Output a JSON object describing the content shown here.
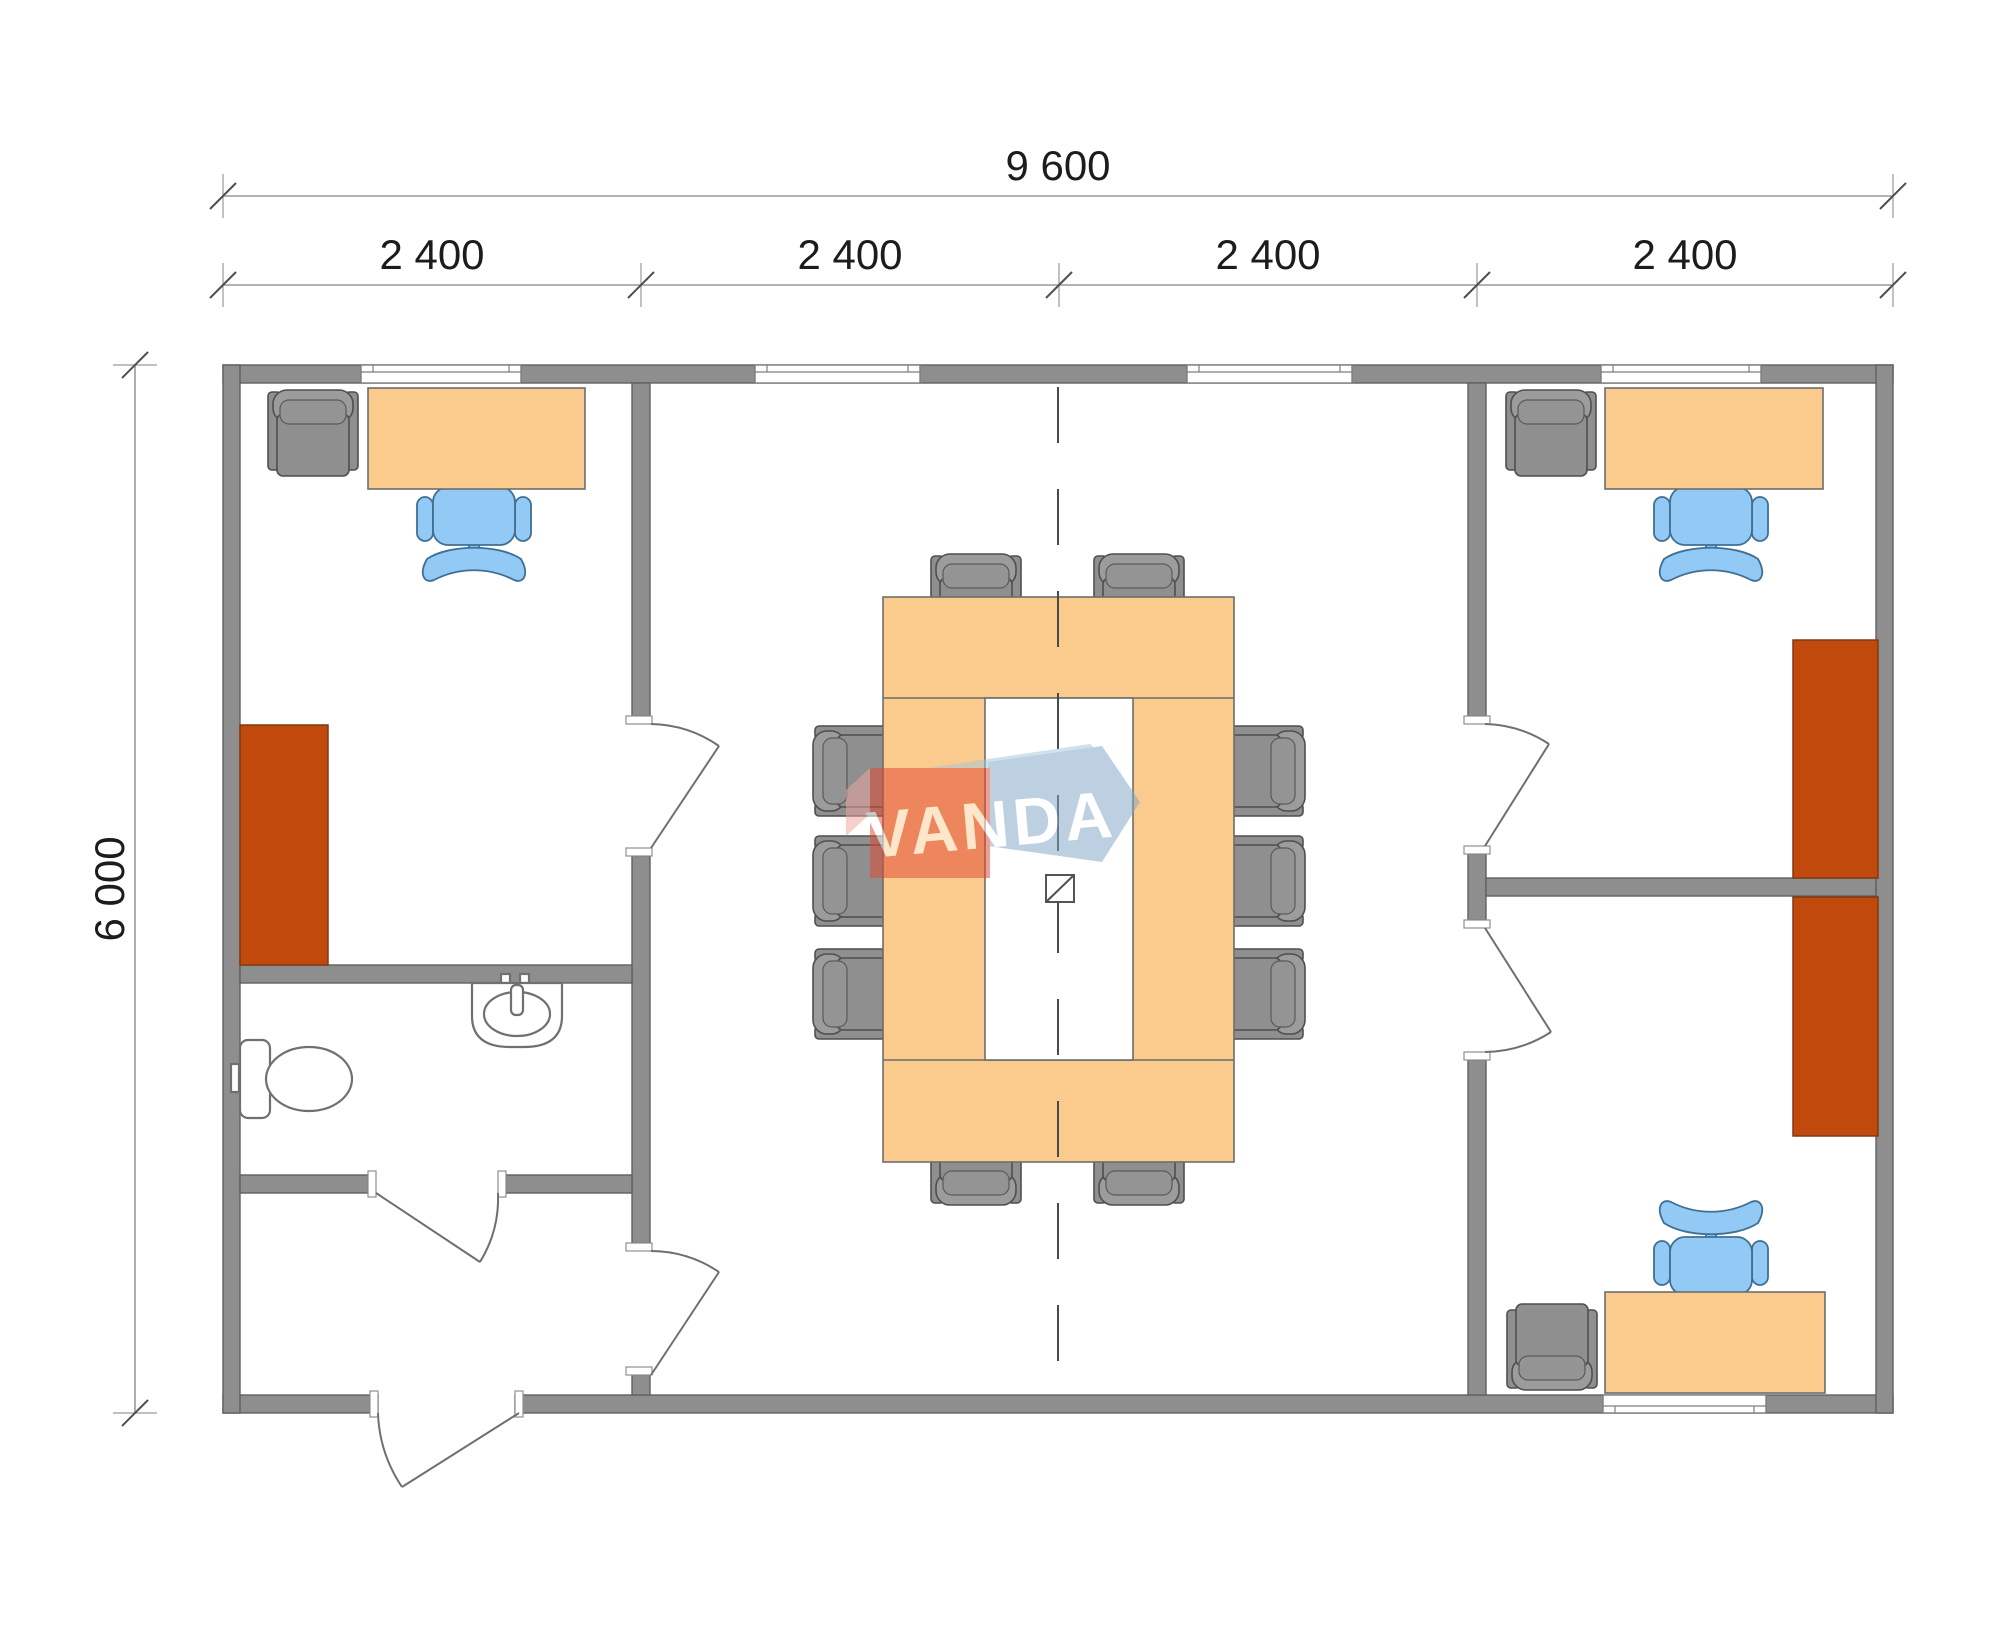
{
  "page": {
    "background": "#ffffff"
  },
  "dimensions": {
    "overall_width": "9 600",
    "modules": [
      "2 400",
      "2 400",
      "2 400",
      "2 400"
    ],
    "overall_height": "6 000"
  },
  "watermark": {
    "text": "VANDA"
  },
  "colors": {
    "wall_fill": "#8e8e8e",
    "wall_stroke": "#606060",
    "desk_fill": "#FBCB8E",
    "cabinet_fill": "#C1490B",
    "office_chair_fill": "#92C9F5",
    "meeting_chair_fill": "#8f8f8f",
    "watermark_red": "#E2492F",
    "watermark_blue": "#7FA6C9",
    "dimension_text": "#1c1c1c"
  }
}
